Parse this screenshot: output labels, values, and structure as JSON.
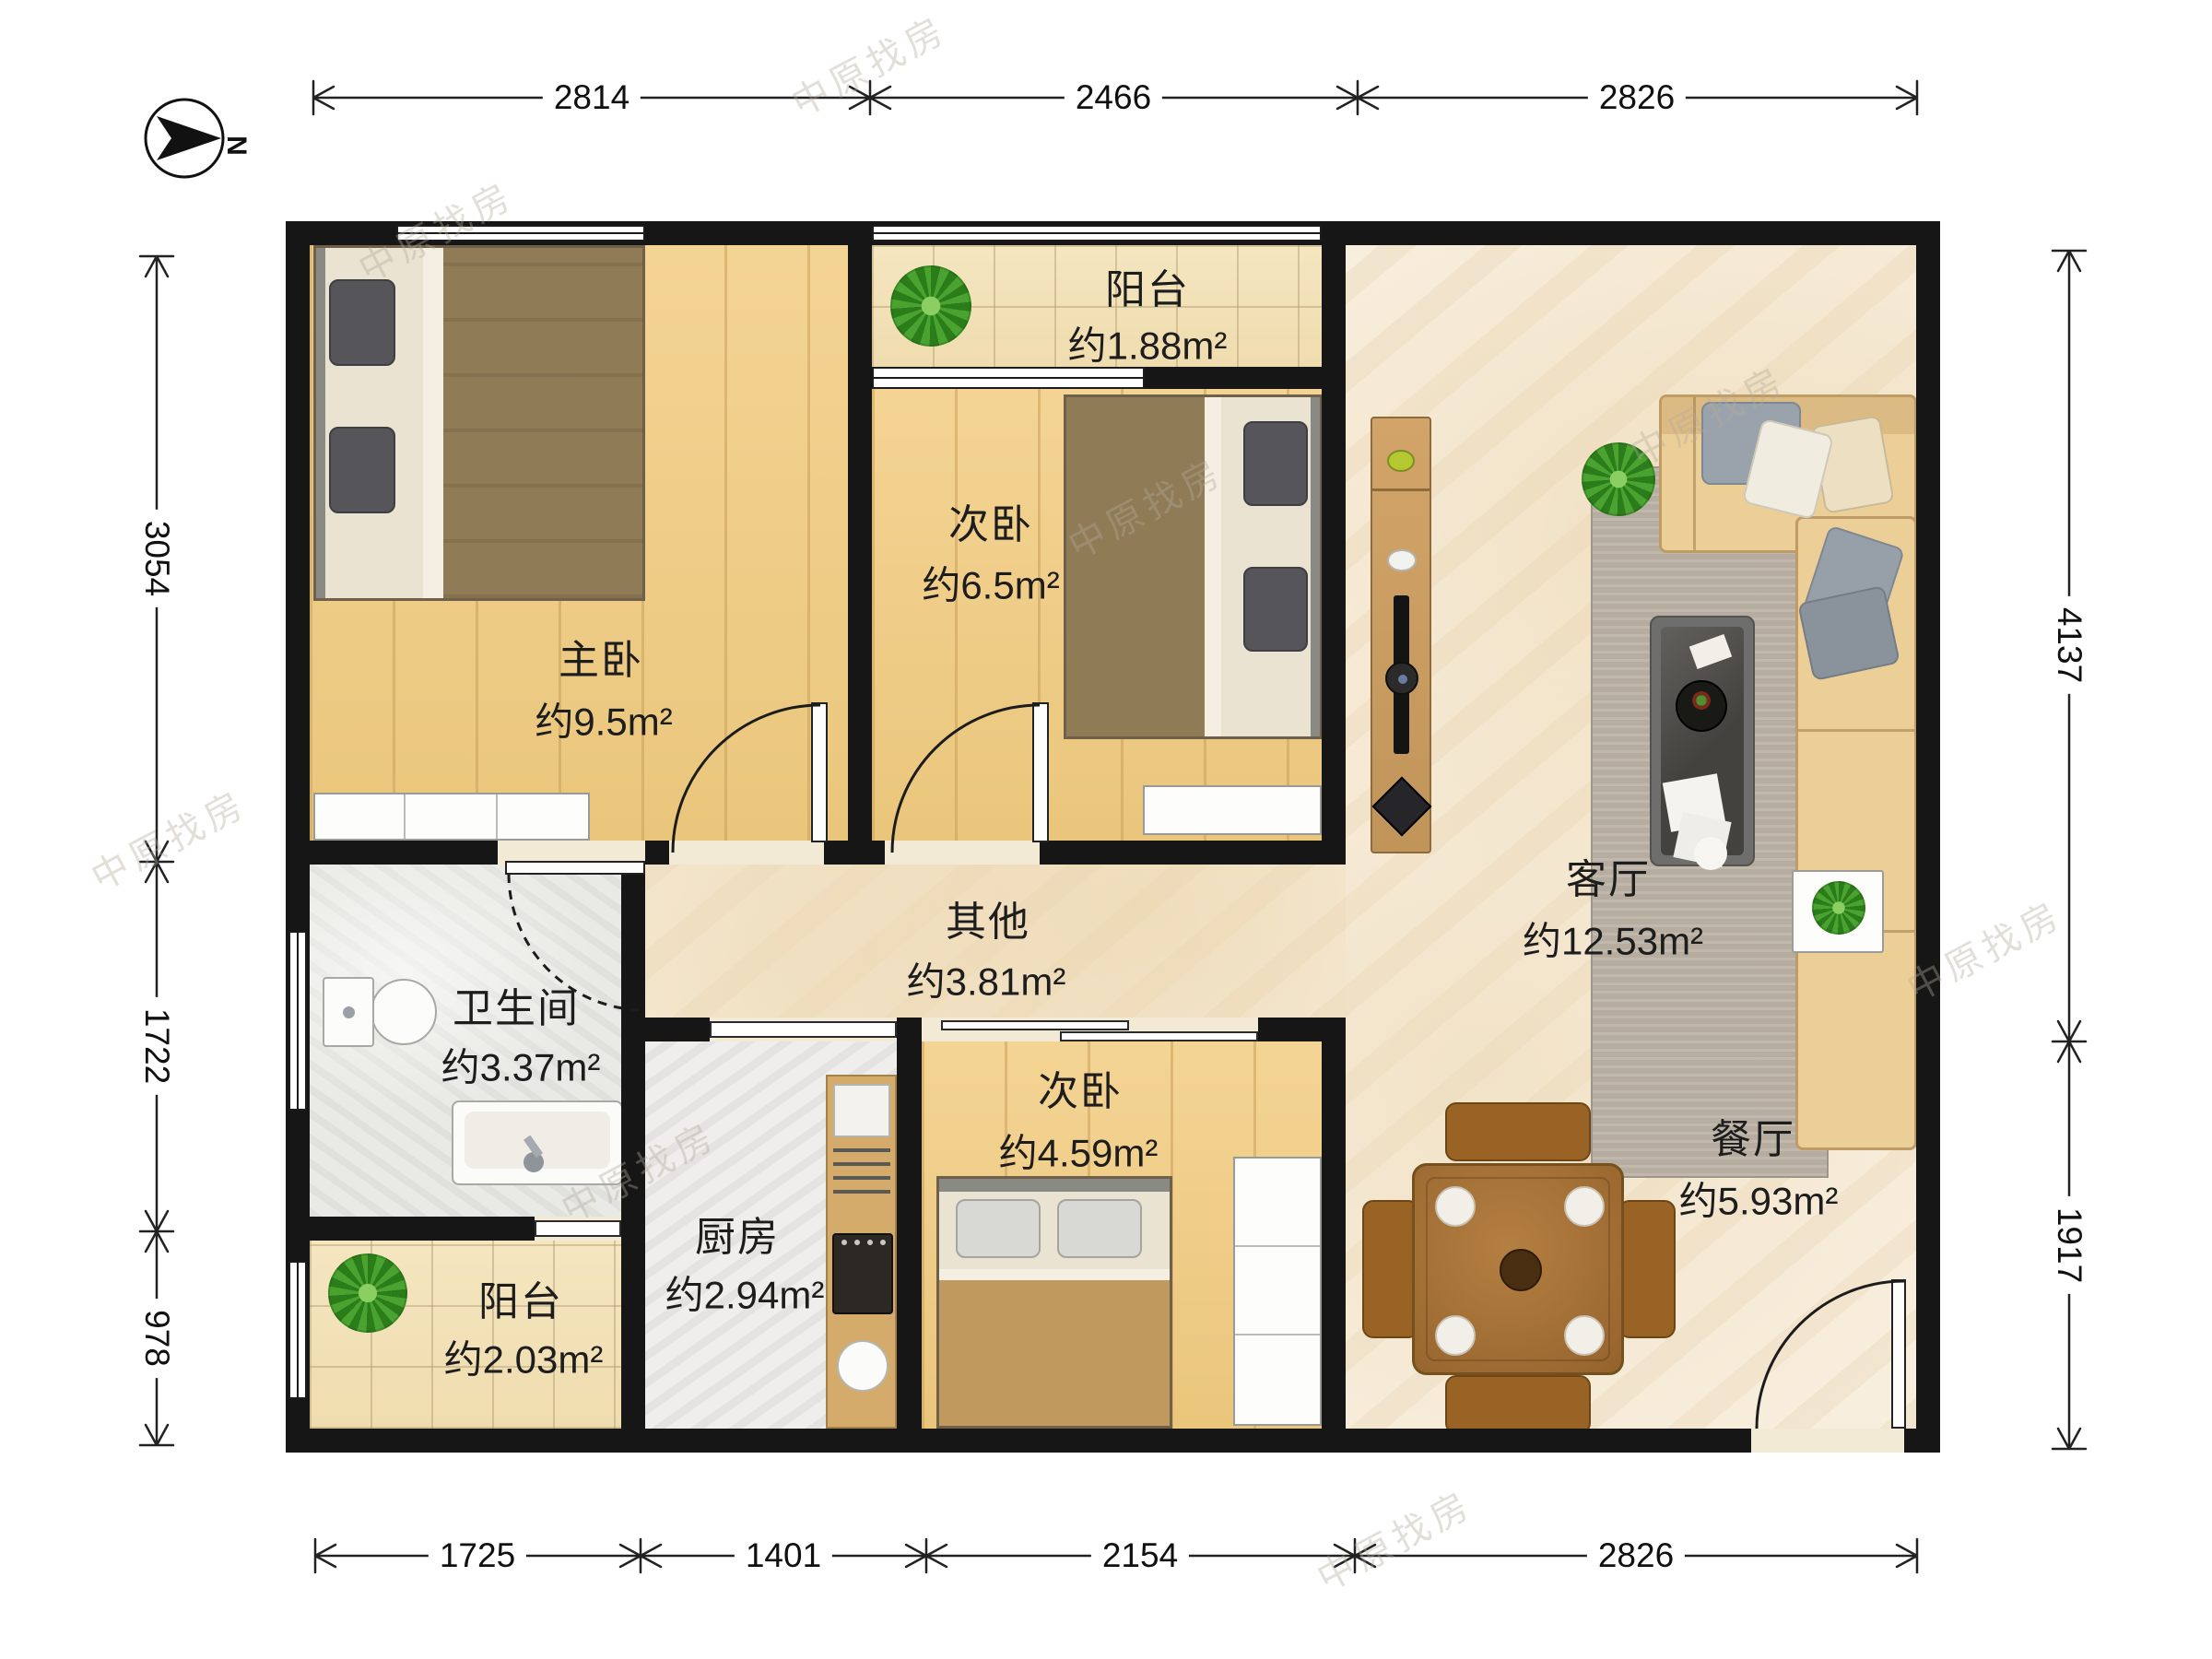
{
  "compass": {
    "label": "N"
  },
  "watermark": {
    "text": "中原找房"
  },
  "rooms": {
    "balcony_top": {
      "name": "阳台",
      "area": "约1.88m²"
    },
    "bedroom_second_top": {
      "name": "次卧",
      "area": "约6.5m²"
    },
    "master_bedroom": {
      "name": "主卧",
      "area": "约9.5m²"
    },
    "living_room": {
      "name": "客厅",
      "area": "约12.53m²"
    },
    "other": {
      "name": "其他",
      "area": "约3.81m²"
    },
    "bathroom": {
      "name": "卫生间",
      "area": "约3.37m²"
    },
    "bedroom_second_bottom": {
      "name": "次卧",
      "area": "约4.59m²"
    },
    "dining_room": {
      "name": "餐厅",
      "area": "约5.93m²"
    },
    "balcony_bottom": {
      "name": "阳台",
      "area": "约2.03m²"
    },
    "kitchen": {
      "name": "厨房",
      "area": "约2.94m²"
    }
  },
  "dimensions": {
    "top": [
      "2814",
      "2466",
      "2826"
    ],
    "bottom": [
      "1725",
      "1401",
      "2154",
      "2826"
    ],
    "left": [
      "3054",
      "1722",
      "978"
    ],
    "right": [
      "4137",
      "1917"
    ]
  },
  "colors": {
    "wall": "#161616",
    "wood_floor": "#f0cd86",
    "tile_floor": "#f3e2b8",
    "marble_floor": "#f8eedd",
    "sofa": "#eccf97",
    "dining_wood": "#a9743a",
    "plant_green": "#3d9128"
  }
}
